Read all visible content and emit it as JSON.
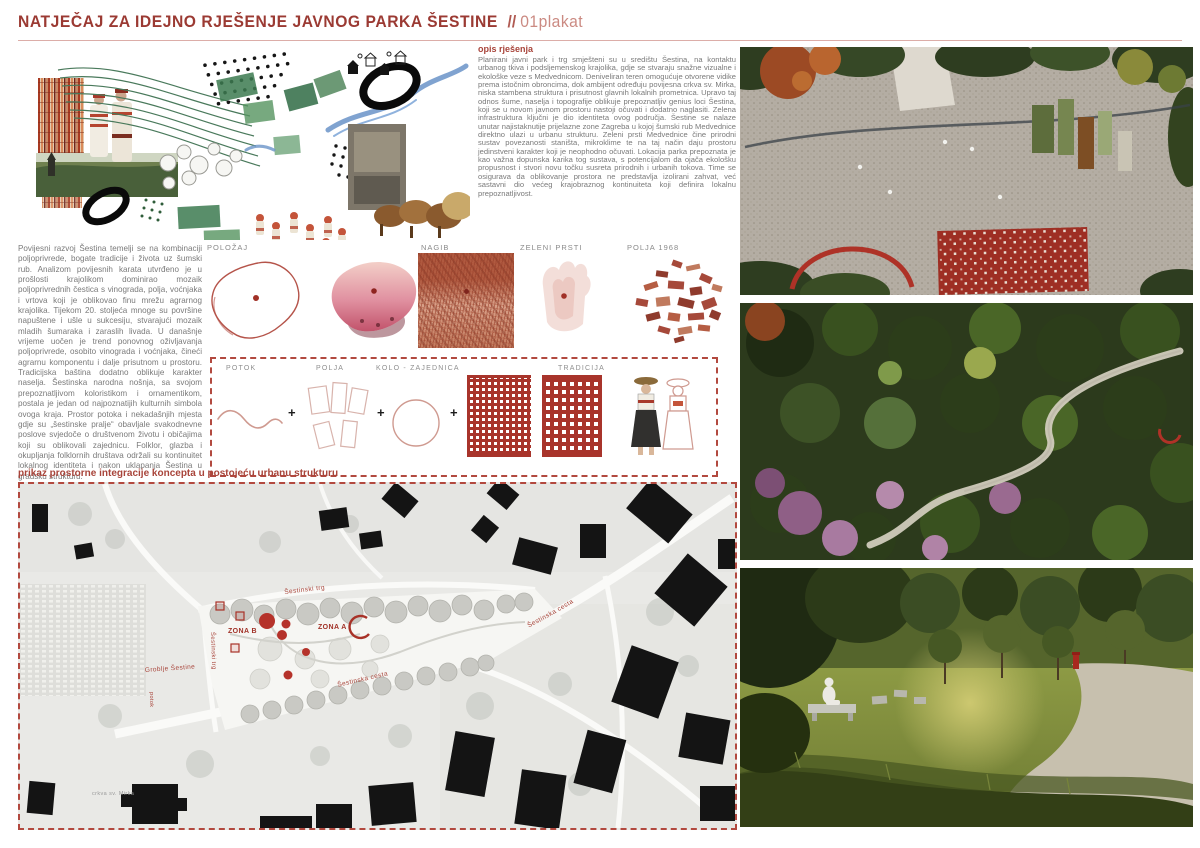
{
  "header": {
    "title": "NATJEČAJ ZA IDEJNO RJEŠENJE JAVNOG PARKA ŠESTINE",
    "separator": "//",
    "sheet": "01plakat"
  },
  "opis": {
    "heading": "opis rješenja",
    "body": "Planirani javni park i trg smješteni su u središtu Šestina, na kontaktu urbanog tkiva i podsljemenskog krajolika, gdje se stvaraju snažne vizualne i ekološke veze s Medvednicom. Deniveliran teren omogućuje otvorene vidike prema istočnim obroncima, dok ambijent određuju povijesna crkva sv. Mirka, niska stambena struktura i prisutnost glavnih lokalnih prometnica. Upravo taj odnos šume, naselja i topografije oblikuje prepoznatljiv genius loci Šestina, koji se u novom javnom prostoru nastoji očuvati i dodatno naglasiti. Zelena infrastruktura ključni je dio identiteta ovog područja. Šestine se nalaze unutar najistaknutije prijelazne zone Zagreba u kojoj šumski rub Medvednice direktno ulazi u urbanu strukturu. Zeleni prsti Medvednice čine prirodni sustav povezanosti staništa, mikroklime te na taj način daju prostoru jedinstveni karakter koji je neophodno očuvati. Lokacija parka prepoznata je kao važna dopunska karika tog sustava, s potencijalom da ojača ekološku propusnost i stvori novu točku susreta prirodnih i urbanih tokova. Time se osigurava da oblikovanje prostora ne predstavlja izolirani zahvat, već sastavni dio većeg krajobraznog kontinuiteta koji definira lokalnu prepoznatljivost."
  },
  "history": {
    "body": "Povijesni razvoj Šestina temelji se na kombinaciji poljoprivrede, bogate tradicije i života uz šumski rub.  Analizom povijesnih karata utvrđeno je u prošlosti krajolikom dominirao mozaik poljoprivrednih čestica s vinograda, polja, voćnjaka i vrtova koji je oblikovao finu mrežu agrarnog krajolika. Tijekom 20. stoljeća mnoge su površine napuštene i ušle u sukcesiju, stvarajući mozaik mladih šumaraka i zaraslih livada. U današnje vrijeme uočen je trend ponovnog oživljavanja poljoprivrede, osobito vinograda i voćnjaka, čineći agrarnu komponentu i dalje prisutnom u prostoru. Tradicijska baština dodatno oblikuje karakter naselja. Šestinska narodna nošnja, sa svojom prepoznatljivom koloristikom i ornamentikom, postala je jedan od najpoznatijih kulturnih simbola ovoga kraja. Prostor potoka i nekadašnjih mjesta gdje su „šestinske pralje“ obavljale svakodnevne poslove svjedoče o društvenom životu i običajima koji su oblikovali zajednicu. Folklor, glazba i okupljanja folklornih društava održali su kontinuitet lokalnog identiteta i nakon uklapanja Šestina u gradsku strukturu."
  },
  "analysis": {
    "labels": [
      "POLOŽAJ",
      "NAGIB",
      "ZELENI PRSTI",
      "POLJA 1968"
    ]
  },
  "concept": {
    "potok": "POTOK",
    "polja": "POLJA",
    "kolo": "KOLO - ZAJEDNICA",
    "tradicija": "TRADICIJA",
    "plus": "+"
  },
  "map": {
    "heading": "prikaz prostorne integracije koncepta u postojeću urbanu strukturu",
    "labels": {
      "trg_curved": "Šestinski trg",
      "trg_vertical": "Šestinski trg",
      "zona_a": "ZONA A",
      "zona_b": "ZONA B",
      "cesta_lower": "Šestinska cesta",
      "cesta_upper": "Šestinska cesta",
      "groblje": "Groblje Šestine",
      "crkva": "crkva sv. Mirka",
      "potok": "potok"
    }
  },
  "colors": {
    "accent_dark": "#9b3a33",
    "accent_light": "#cb8a82",
    "dashed_border": "#b2493f",
    "body_text": "#7a7a7a",
    "map_label": "#a8443a",
    "embroidery_red": "#a8342b"
  }
}
